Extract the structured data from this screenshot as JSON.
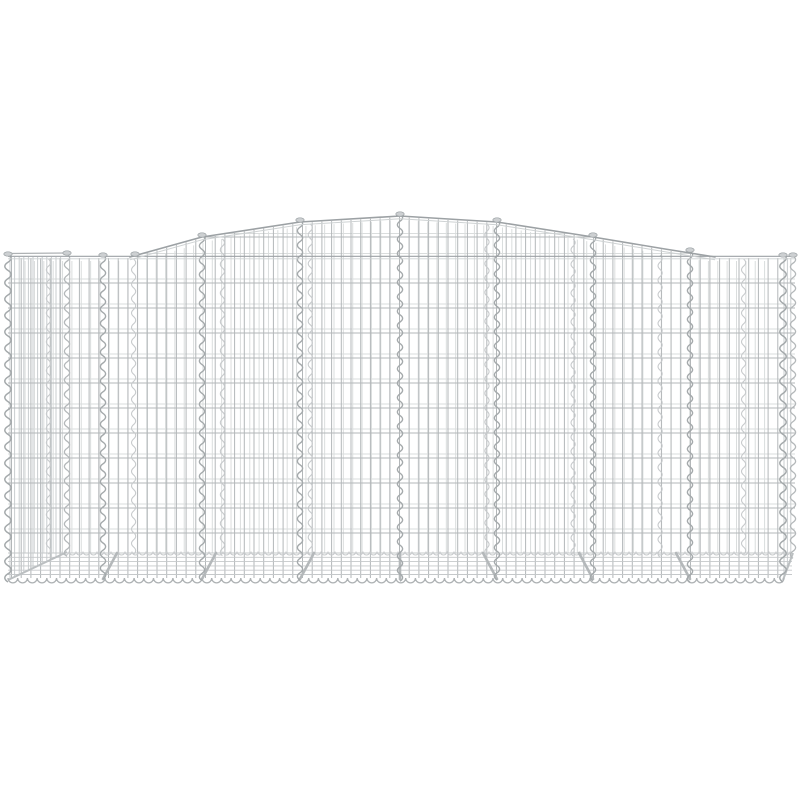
{
  "meta": {
    "alt": "Arched gabion basket made of galvanised iron wire mesh, product photo on white background",
    "subject": "arched-gabion-wire-basket"
  },
  "canvas": {
    "width": 800,
    "height": 800,
    "background": "#ffffff"
  },
  "colors": {
    "wireFront": "#b3b7b9",
    "wireBack": "#dadddd",
    "wireDense": "#c9cdcf",
    "spiral": "#a4a9ab",
    "spiralEcho": "#c7cacc",
    "frame": "#9ca1a4",
    "frameLight": "#ced2d3",
    "floorWire": "#c5c8ca",
    "brace": "#b4b8ba",
    "blobFill": "#cdd0d2",
    "blobStroke": "#9aa0a3",
    "scallopFront": "#aeb2b4",
    "scallopBack": "#c6c9cb",
    "edgeDiagonal": "#bbbfc1"
  },
  "basket": {
    "left": 8,
    "right": 783,
    "farRight": 795,
    "shoulderY": 257,
    "bottomY": 580,
    "floorBackY": 552,
    "silhouette": [
      [
        8,
        257
      ],
      [
        130,
        257
      ],
      [
        202,
        237
      ],
      [
        300,
        222
      ],
      [
        400,
        216
      ],
      [
        497,
        222
      ],
      [
        593,
        237
      ],
      [
        665,
        249
      ],
      [
        715,
        257
      ],
      [
        795,
        257
      ]
    ],
    "archOutlineRange": [
      130,
      715
    ],
    "verticalStartX": 11.5,
    "wireSpacingX": 9.7,
    "horizontalYs": [
      283,
      308,
      333,
      358,
      383,
      408,
      433,
      458,
      483,
      508,
      533
    ],
    "archWireY": 237,
    "backShoulderY": 253.5,
    "backOffsetY": 4,
    "backOffsetFactor": 0.035,
    "braceLeanFactor": 0.045,
    "dividerXs": [
      103,
      202,
      300,
      400,
      497,
      593,
      690
    ],
    "edgeXs": [
      8,
      783
    ],
    "spiralAmp": 2.6,
    "spiralPeriod": 7.2,
    "leftEnd": {
      "x1": 10,
      "x2": 65,
      "spacing": 4.6,
      "backX": 67,
      "slope": 0.49
    },
    "rightEnd": {
      "x1": 784,
      "x2": 794,
      "spacing": 3.4,
      "backX": 793
    },
    "floor": {
      "topY": 553,
      "bottomY": 577,
      "spacing": 4.3
    },
    "scallop": {
      "frontY": 578,
      "frontR": 4.85,
      "period": 9.7,
      "backY": 551.5,
      "backR": 3.5,
      "backPeriod": 7,
      "backX1": 62
    },
    "frameLines": {
      "shoulderDark": 256.3,
      "shoulderLight": 258.8,
      "leftTopEdge": [
        [
          8,
          253.5
        ],
        [
          67,
          253
        ]
      ]
    },
    "blobs": [
      [
        8,
        254
      ],
      [
        67,
        253
      ],
      [
        103,
        255
      ],
      [
        135,
        254
      ],
      [
        202,
        235
      ],
      [
        300,
        220
      ],
      [
        400,
        214
      ],
      [
        497,
        220
      ],
      [
        593,
        235
      ],
      [
        690,
        250
      ],
      [
        783,
        255
      ],
      [
        793,
        255
      ]
    ]
  }
}
